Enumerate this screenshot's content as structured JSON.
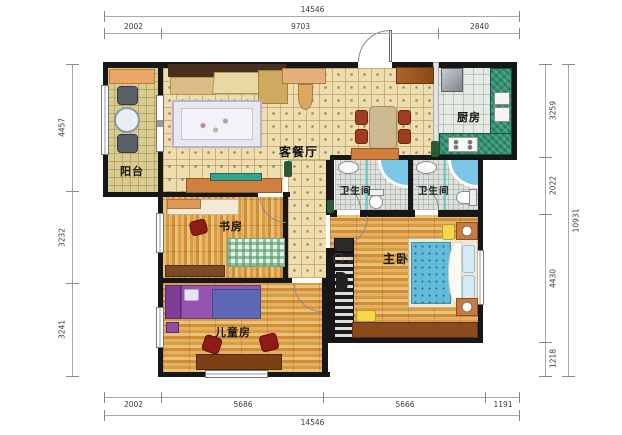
{
  "plan": {
    "watermark": "全屋定制",
    "rooms": {
      "balcony": {
        "label": "阳台"
      },
      "living_dining": {
        "label": "客餐厅"
      },
      "kitchen": {
        "label": "厨房"
      },
      "bathroom1": {
        "label": "卫生间"
      },
      "bathroom2": {
        "label": "卫生间"
      },
      "study": {
        "label": "书房"
      },
      "master": {
        "label": "主卧"
      },
      "kids": {
        "label": "儿童房"
      }
    },
    "dimensions": {
      "top": {
        "total": "14546",
        "segments": [
          "2002",
          "9703",
          "2840"
        ]
      },
      "bottom": {
        "total": "14546",
        "segments": [
          "2002",
          "5686",
          "5666",
          "1191"
        ]
      },
      "left": {
        "segments": [
          "4457",
          "3232",
          "3241"
        ]
      },
      "right": {
        "total": "10931",
        "segments": [
          "3259",
          "2022",
          "4430",
          "1218"
        ]
      }
    },
    "colors": {
      "wall": "#171717",
      "tile_floor": "#eeddae",
      "wood_floor": "#dfa855",
      "kitchen_counter": "#2f8f70",
      "bed_blue": "#62bbdb",
      "kids_bed_purple": "#8e44ad",
      "accent_orange": "#d0803e",
      "chair_red": "#8e1c14"
    }
  }
}
